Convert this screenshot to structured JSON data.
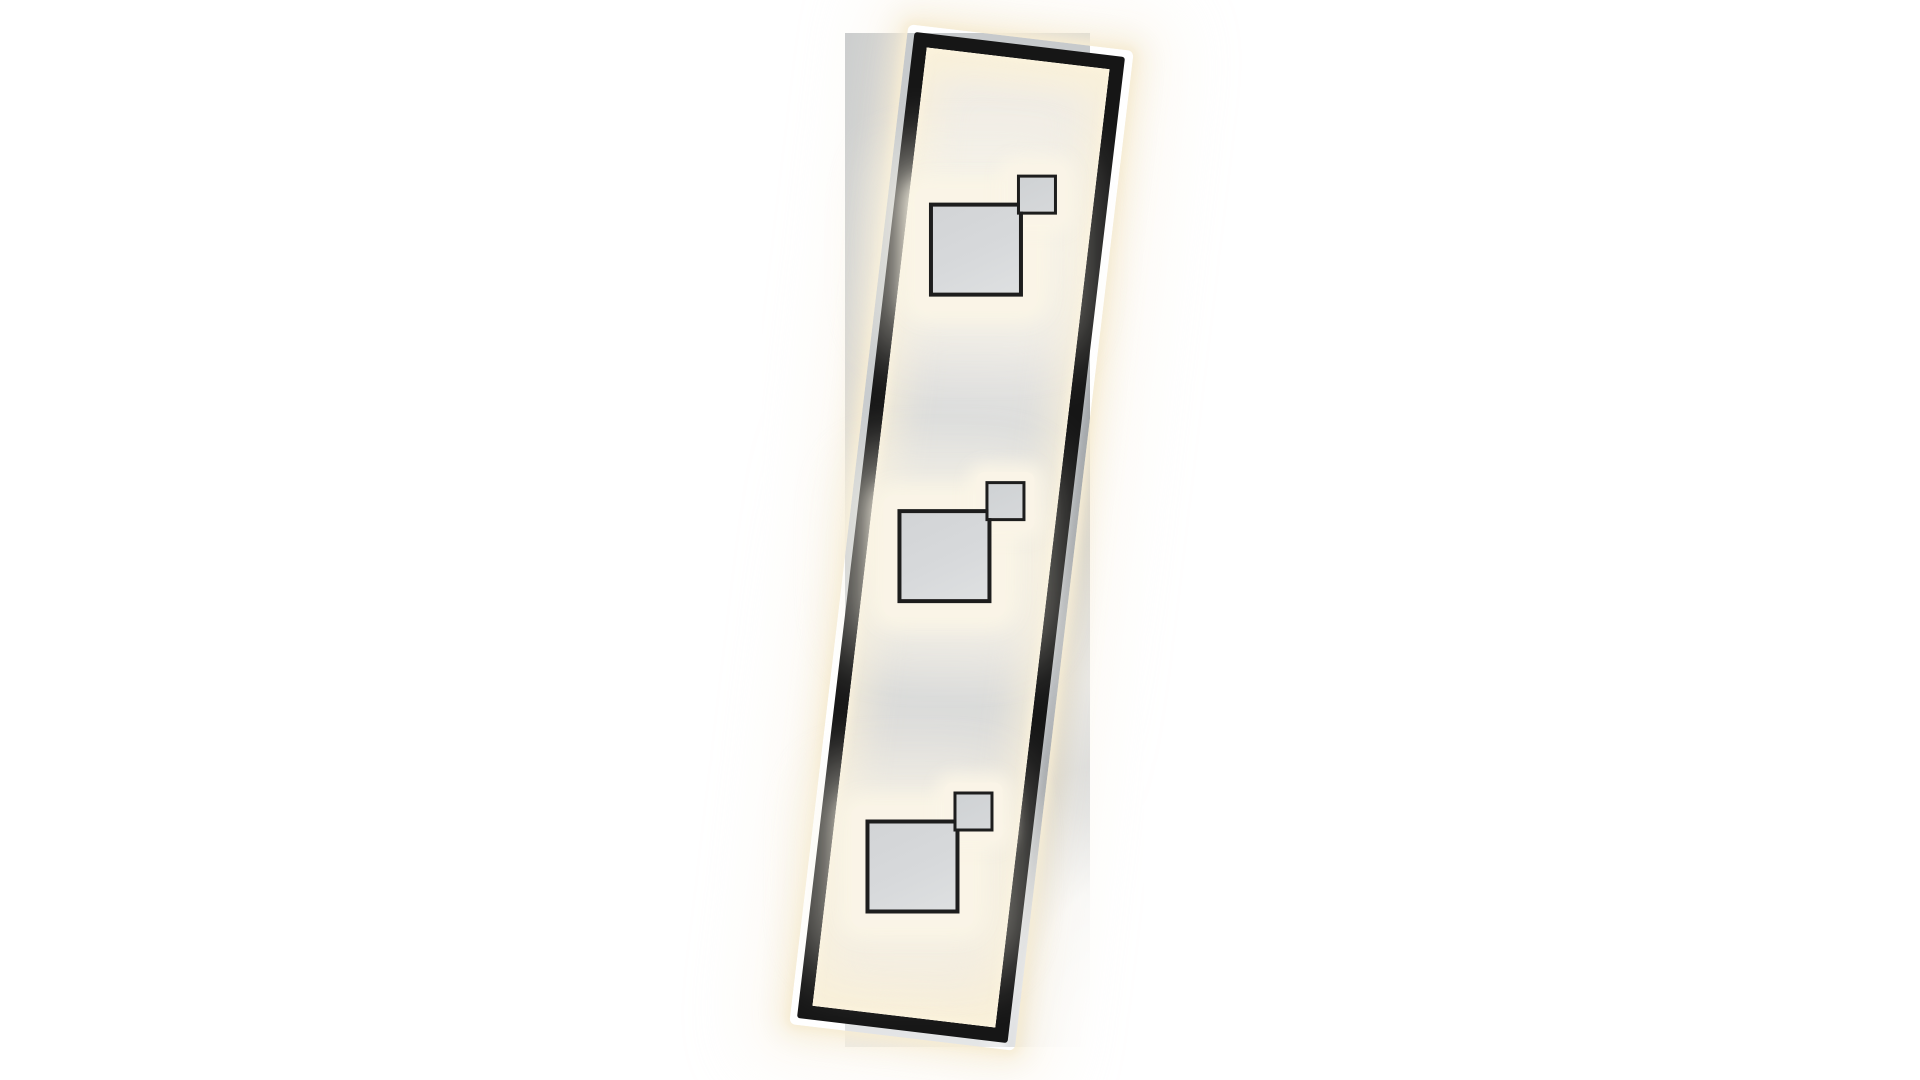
{
  "page": {
    "title": "LED panel light product photo",
    "background": "#ffffff"
  },
  "scene": {
    "description": "Product photograph of a rectangular LED ceiling/wall light: a slim black metal frame, tilted clockwise, overlaid on a straight grey mounting plate. Inside the frame a lit diffuser panel carries three modules, each a large grey square and a small grey square with thin black borders, overlapping at the corner, all surrounded by warm-white LED glow.",
    "fixture": {
      "frame_tilt_deg": 6.8,
      "module_count": 3,
      "modules": [
        {
          "id": "top",
          "large_square": "grey, black border",
          "small_square": "grey, black border, upper-right"
        },
        {
          "id": "middle",
          "large_square": "grey, black border",
          "small_square": "grey, black border, upper-right"
        },
        {
          "id": "bottom",
          "large_square": "grey, black border",
          "small_square": "grey, black border, upper-right"
        }
      ],
      "light_color": "warm white"
    }
  },
  "colors": {
    "bg": "#ffffff",
    "plate": "#c9cccd",
    "plate-light": "#e2e3e4",
    "frame": "#161616",
    "sq-fill-a": "#d2d4d6",
    "sq-fill-b": "#dee0e1",
    "sq-border": "#1d1d1d",
    "glow-strong": "#f6ecd4",
    "glow-soft": "#f9f1e2",
    "halo": "#faf4e7",
    "panel-gray": "#dbdcdb",
    "panel-cream": "#f4efe3",
    "shadow": "#646a70"
  }
}
